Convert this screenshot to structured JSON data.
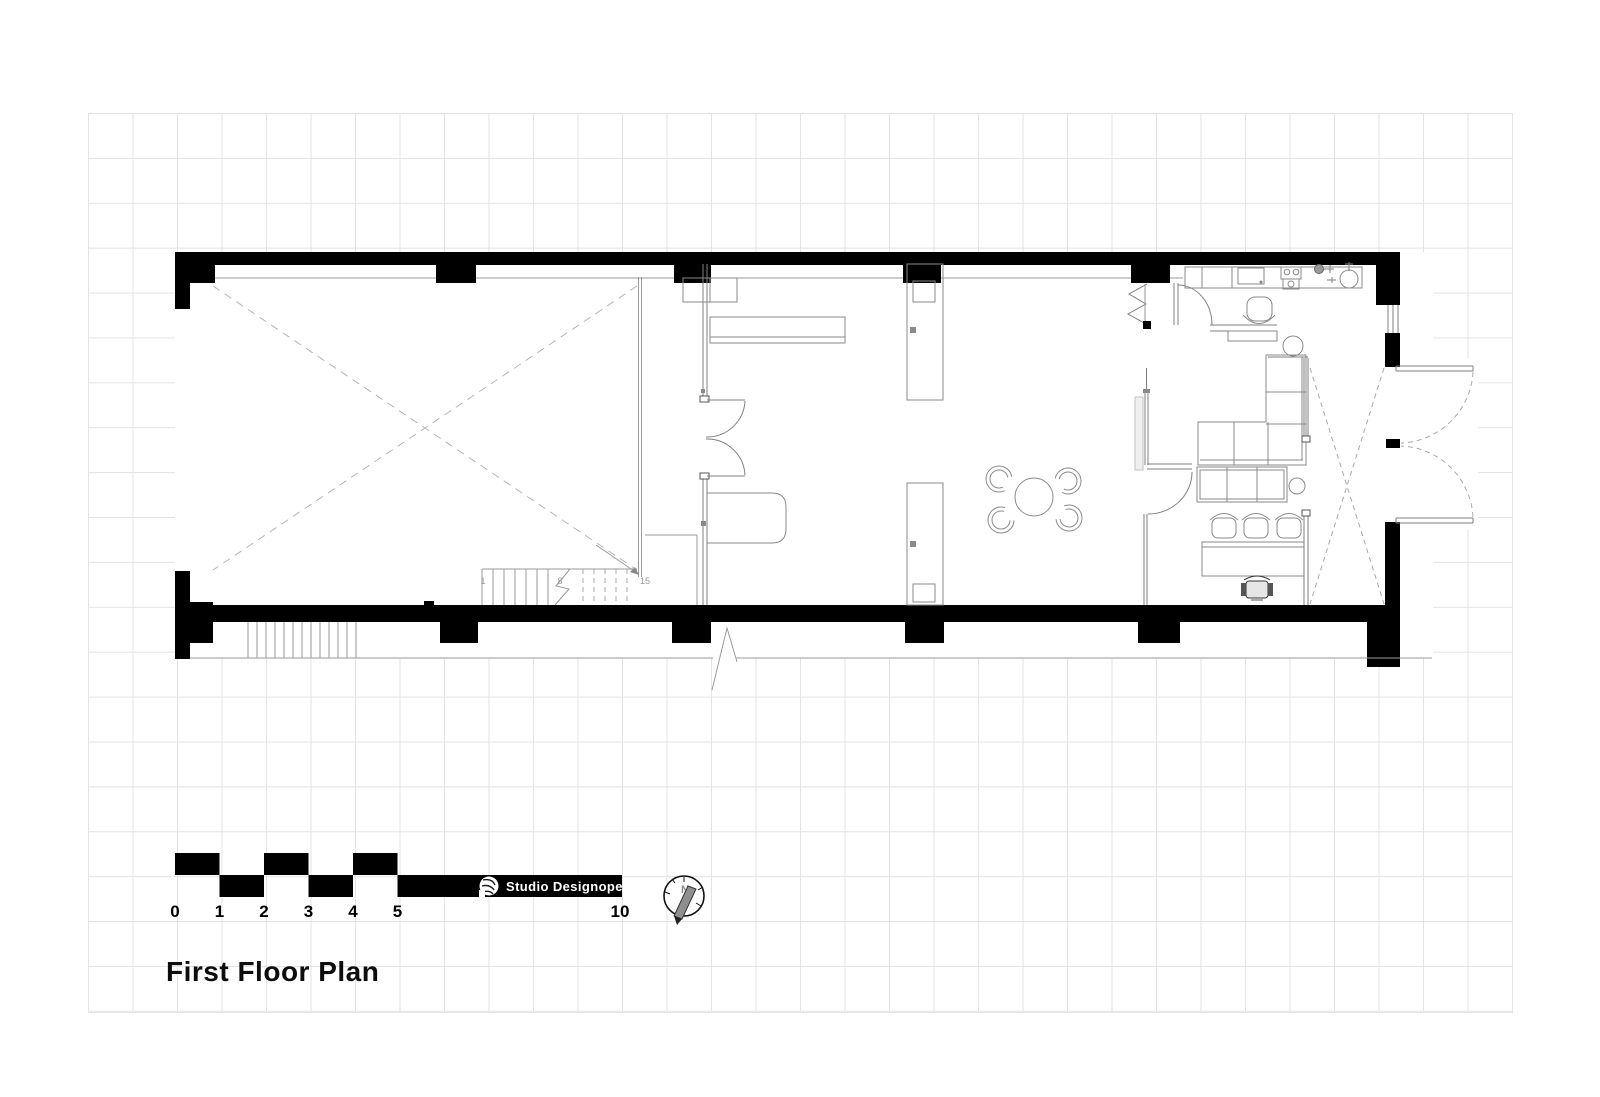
{
  "title": {
    "text": "First Floor Plan"
  },
  "branding": {
    "studio_name": "Studio Designopedia"
  },
  "scale_bar": {
    "numbers": {
      "n0": "0",
      "n1": "1",
      "n2": "2",
      "n3": "3",
      "n4": "4",
      "n5": "5",
      "n10": "10"
    }
  },
  "north_indicator": {
    "label": "N"
  },
  "stairs": {
    "labels": {
      "first": "1",
      "middle": "8",
      "last": "15"
    }
  },
  "colors": {
    "wall": "#000000",
    "grid": "#e3e3e3",
    "thin_line": "#7f7f7f",
    "dashed": "#b5b5b5"
  }
}
